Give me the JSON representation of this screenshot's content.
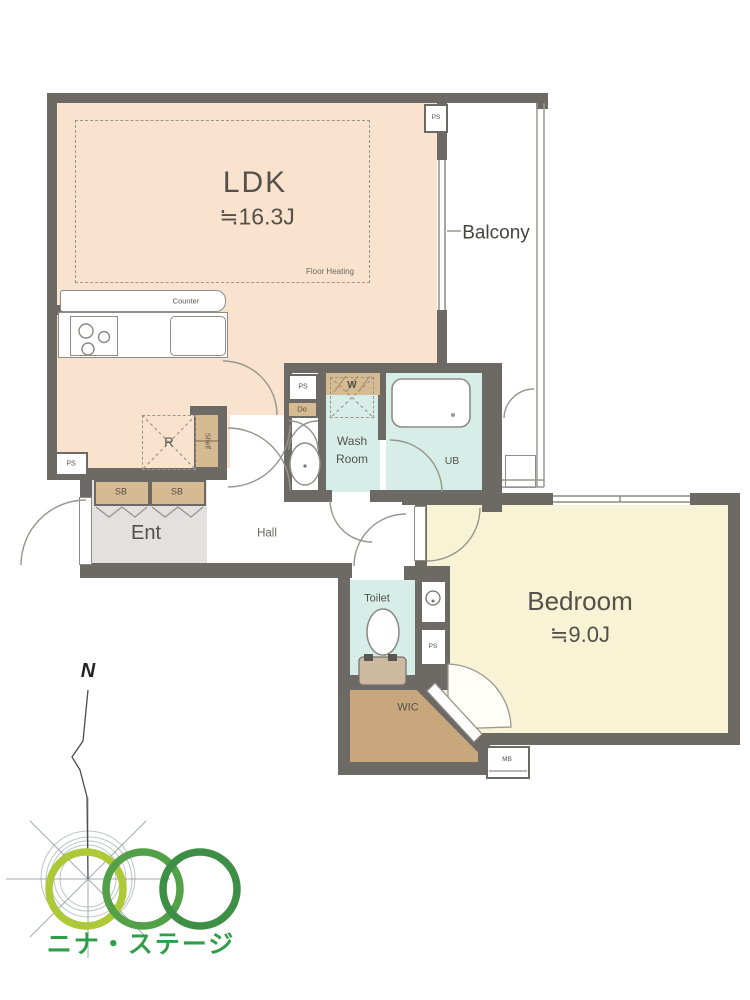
{
  "plan": {
    "ldk": {
      "name": "LDK",
      "size": "≒16.3J",
      "floor_heating_label": "Floor Heating",
      "fridge_label": "R",
      "shelf_label": "Shelf"
    },
    "kitchen": {
      "counter_label": "Counter"
    },
    "balcony": {
      "name": "Balcony"
    },
    "entrance": {
      "name": "Ent",
      "shoe_box_1": "SB",
      "shoe_box_2": "SB"
    },
    "hall": {
      "name": "Hall"
    },
    "washroom": {
      "name_line1": "Wash",
      "name_line2": "Room",
      "washer_label": "W",
      "door_label": "Do"
    },
    "bath": {
      "name": "UB"
    },
    "toilet": {
      "name": "Toilet"
    },
    "wic": {
      "name": "WIC"
    },
    "bedroom": {
      "name": "Bedroom",
      "size": "≒9.0J"
    },
    "shafts": {
      "ps_top": "PS",
      "ps_entry": "PS",
      "ps_utility": "PS",
      "ps_toilet": "PS",
      "meter_box": "MB"
    }
  },
  "compass": {
    "north_label": "N"
  },
  "logo": {
    "text": "ニナ・ステージ",
    "text_color": "#2f9e49",
    "circle_colors": [
      "#aec937",
      "#52a047",
      "#3d8f45"
    ]
  },
  "colors": {
    "wall": "#6d6965",
    "ldk_floor": "#fae3ce",
    "bedroom_floor": "#f7f3d4",
    "wet_area_floor": "#d7eee8",
    "wic_floor": "#c9a77d",
    "cabinet": "#d6ba92",
    "entrance_floor": "#e2e1df"
  }
}
